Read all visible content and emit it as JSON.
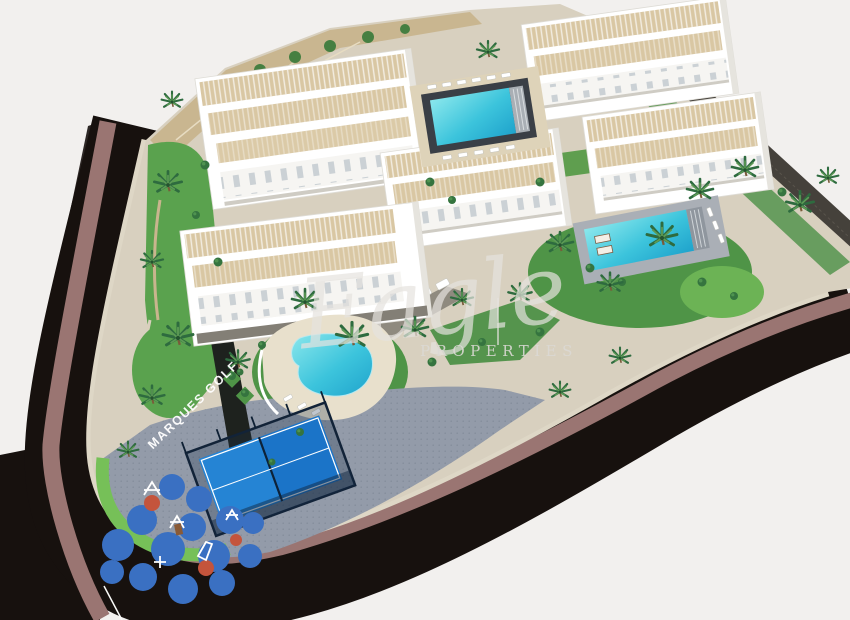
{
  "meta": {
    "title": "Aerial 3D render of a residential development beside a curved road",
    "width": 850,
    "height": 620
  },
  "watermark": {
    "script": "Eagle",
    "caps": "PROPERTIES"
  },
  "labels": {
    "promenade": "MARQUES GOLF"
  },
  "colors": {
    "background": "#f2f0ee",
    "road_asphalt": "#17110e",
    "road_median": "#9a7572",
    "curb": "#ded7c6",
    "site_paving": "#d8d0bf",
    "plaza": "#939ba9",
    "grass": "#5aa24e",
    "grass_bright": "#76c058",
    "grass_dark": "#4f9447",
    "stone_wall": "#c9b690",
    "boundary_wall": "#45413b",
    "building_white": "#ffffff",
    "terrace_beige": "#d9c7a3",
    "pool_water": "#3cc4dc",
    "pool_deck_dark": "#3a3f46",
    "pool_deck_light": "#aaafb6",
    "padel_blue": "#1b74c8",
    "padel_fence": "#122338",
    "playground_mat": "#3a70c2",
    "playground_accent": "#c4543c",
    "palm_green": "#2e6b3f"
  },
  "scene": {
    "building_blocks": 5,
    "swimming_pools": 3,
    "padel_courts": 1,
    "playgrounds": 1,
    "road_wraps_site": true
  }
}
